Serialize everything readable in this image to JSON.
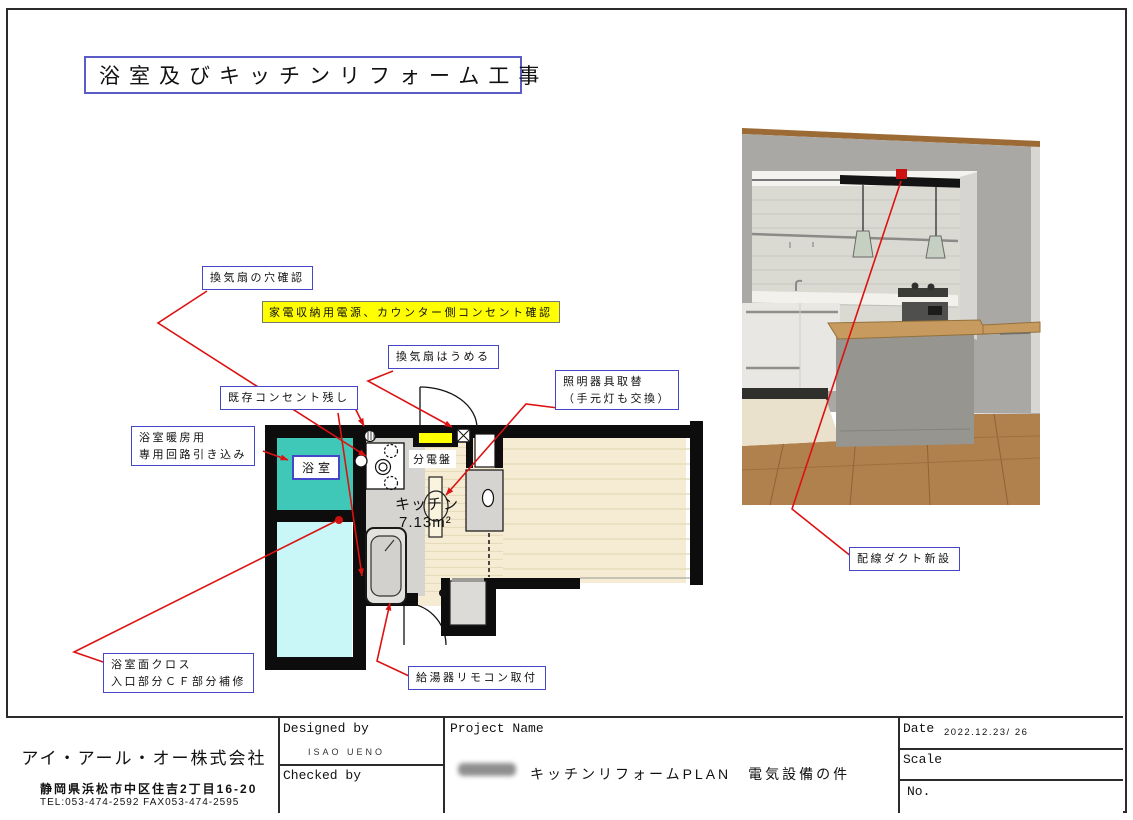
{
  "page": {
    "title": "浴室及びキッチンリフォーム工事"
  },
  "plan": {
    "rooms": {
      "bathroom": "浴室",
      "kitchen": "キッチン",
      "kitchen_area": "7.13m²",
      "panel": "分電盤"
    },
    "annotations": {
      "vent_hole": "換気扇の穴確認",
      "appliance_power": "家電収納用電源、カウンター側コンセント確認",
      "vent_fill": "換気扇はうめる",
      "existing_outlet": "既存コンセント残し",
      "light_replace_1": "照明器具取替",
      "light_replace_2": "（手元灯も交換）",
      "bath_heating_1": "浴室暖房用",
      "bath_heating_2": "専用回路引き込み",
      "bath_cloth_1": "浴室面クロス",
      "bath_cloth_2": "入口部分ＣＦ部分補修",
      "heater_remote": "給湯器リモコン取付",
      "wiring_duct": "配線ダクト新設"
    }
  },
  "title_block": {
    "company_name": "アイ・アール・オー株式会社",
    "company_address": "静岡県浜松市中区住吉2丁目16-20",
    "company_tel": "TEL:053-474-2592 FAX053-474-2595",
    "designed_by_label": "Designed by",
    "designed_by_value": "ISAO UENO",
    "checked_by_label": "Checked by",
    "project_name_label": "Project Name",
    "project_name_value": "キッチンリフォームPLAN　電気設備の件",
    "date_label": "Date",
    "date_value": "2022.12.23/ 26",
    "scale_label": "Scale",
    "no_label": "No."
  },
  "colors": {
    "bathroom_fill": "#3fc8b8",
    "second_room_fill": "#c9f6f7",
    "floor_fill": "#f5ecd3",
    "highlight_yellow": "#ffff00",
    "leader_red": "#dd1111",
    "note_border_blue": "#4646c8"
  }
}
